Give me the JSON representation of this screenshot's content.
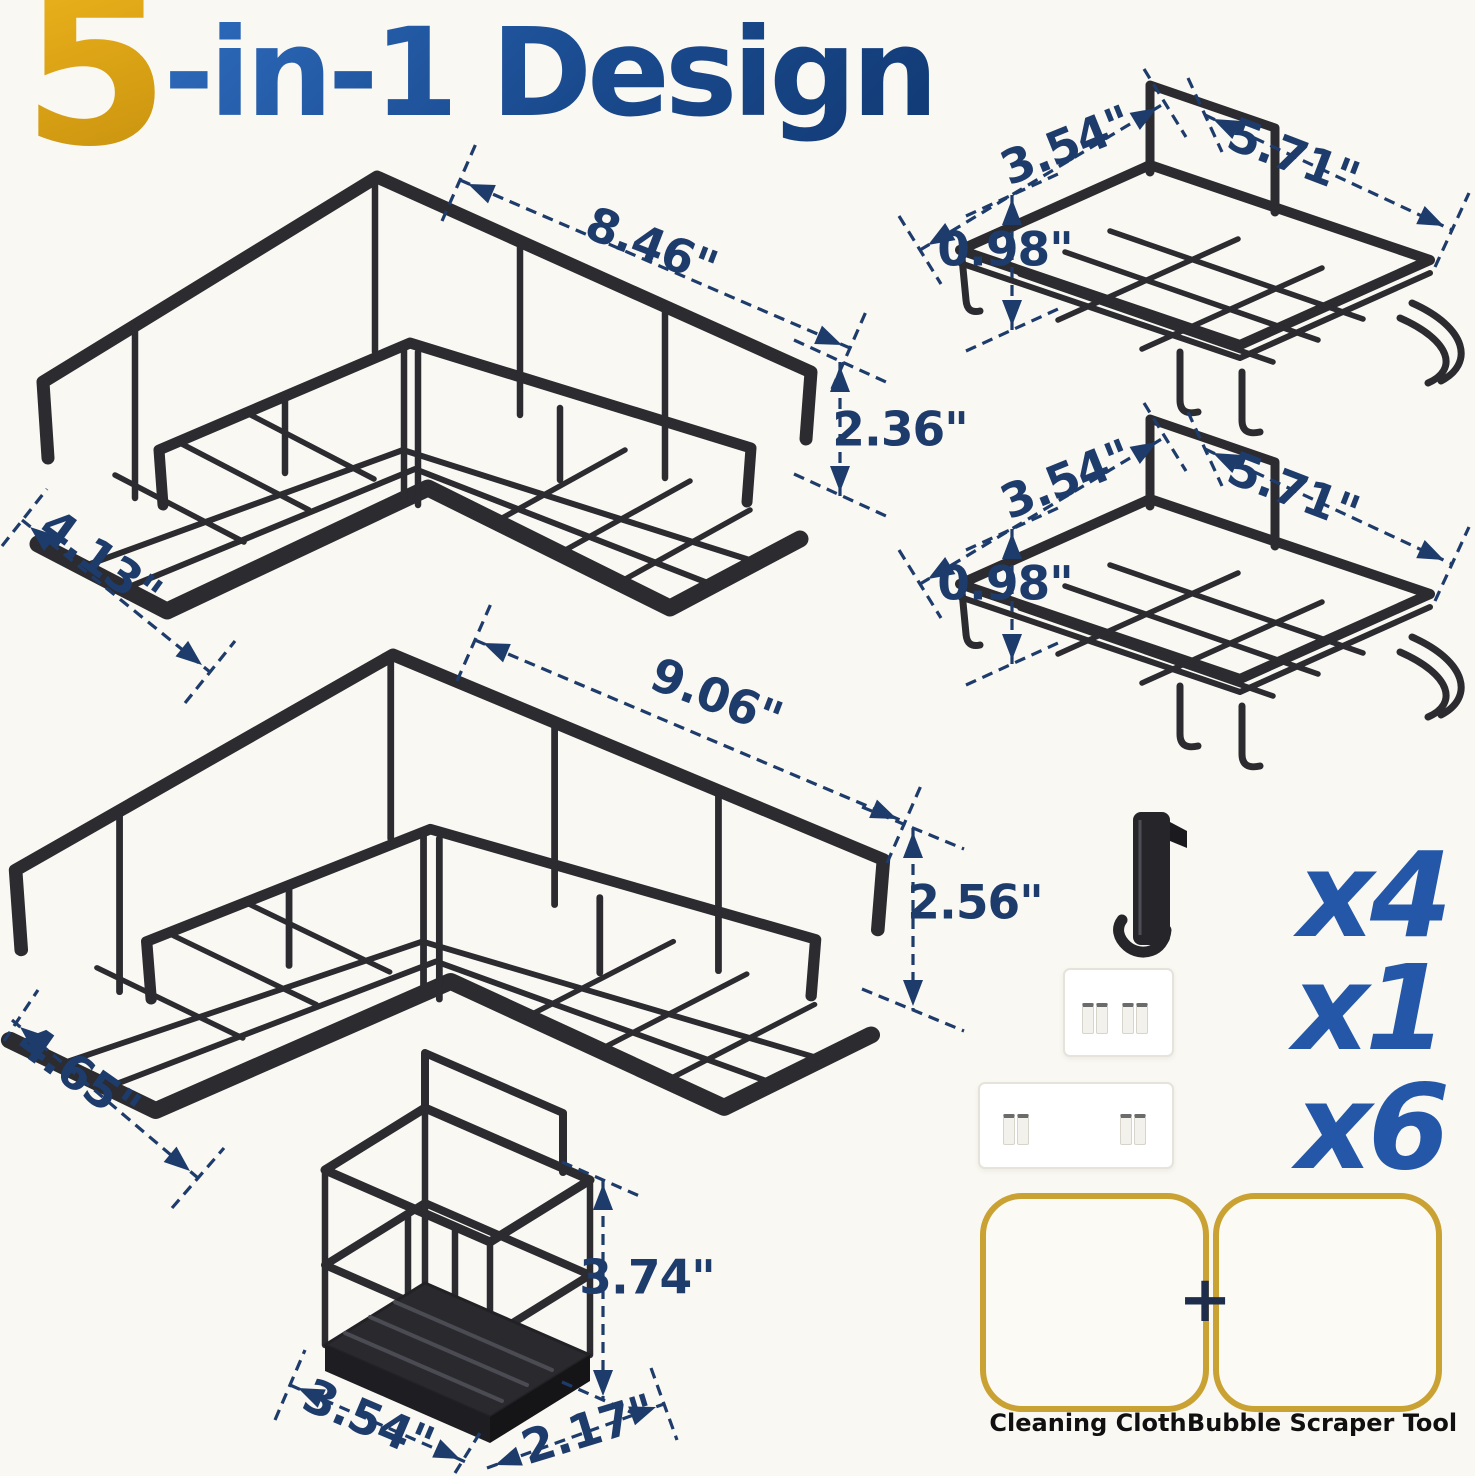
{
  "title": {
    "number": "5",
    "suffix": "-in-1 Design"
  },
  "products": {
    "corner_caddy_small": {
      "name": "small corner caddy",
      "width": "8.46\"",
      "height": "2.36\"",
      "depth": "4.13\""
    },
    "corner_caddy_large": {
      "name": "large corner caddy",
      "width": "9.06\"",
      "height": "2.56\"",
      "depth": "4.65\""
    },
    "soap_shelf_top": {
      "name": "wall shelf with hooks",
      "depth": "3.54\"",
      "width": "5.71\"",
      "height": "0.98\""
    },
    "soap_shelf_bottom": {
      "name": "wall shelf with hooks",
      "depth": "3.54\"",
      "width": "5.71\"",
      "height": "0.98\""
    },
    "utensil_holder": {
      "name": "utensil holder",
      "height": "3.74\"",
      "width": "3.54\"",
      "depth": "2.17\""
    }
  },
  "accessories": {
    "hook_qty": "x4",
    "adhesive_small_qty": "x1",
    "adhesive_large_qty": "x6",
    "plus_sign": "+",
    "cleaning_cloth_label": "Cleaning Cloth",
    "bubble_scraper_label": "Bubble Scraper Tool"
  },
  "colors": {
    "background": "#faf8f2",
    "dimension_text": "#1e3c6b",
    "quantity_text": "#2457a7",
    "title_number": "#d7a013",
    "title_text": "#1a4788",
    "wire": "#2b2b30",
    "gold_border": "#c9a233",
    "scraper_yellow": "#f0ba12",
    "cloth_blue": "#bdd2e0"
  }
}
